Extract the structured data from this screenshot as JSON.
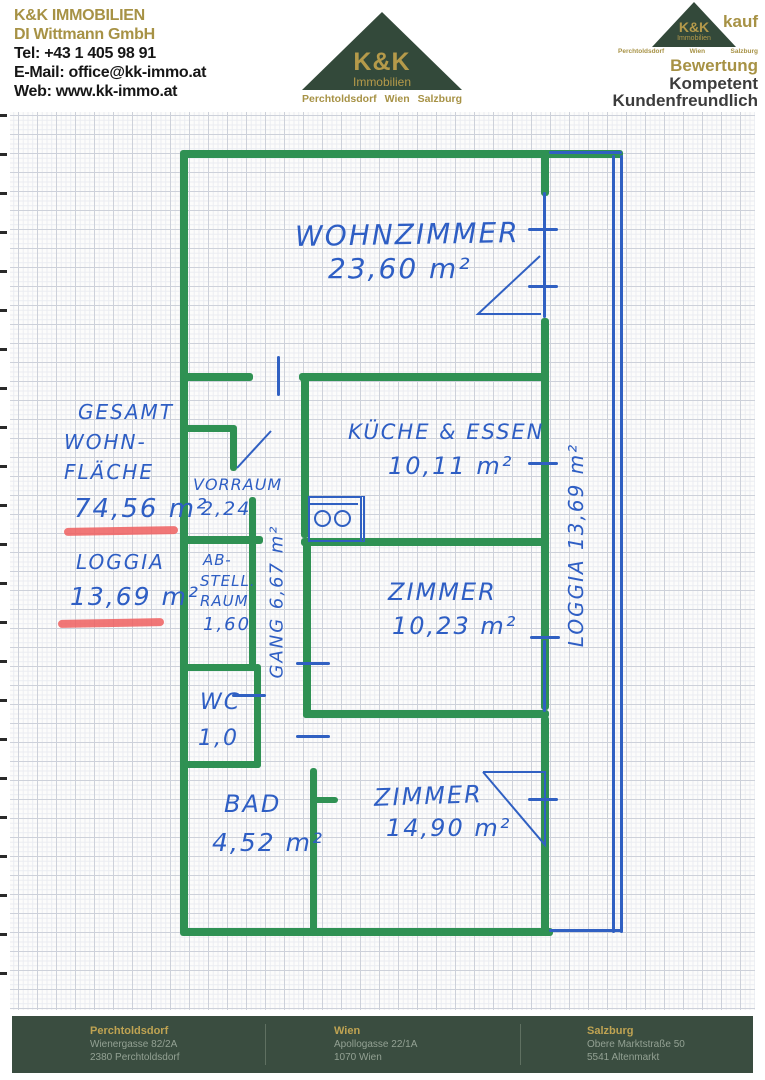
{
  "header": {
    "company": {
      "name": "K&K IMMOBILIEN",
      "subtitle": "DI Wittmann GmbH",
      "tel": "Tel: +43 1 405 98 91",
      "email": "E-Mail: office@kk-immo.at",
      "web": "Web: www.kk-immo.at"
    },
    "logo": {
      "brand": "K&K",
      "brand_sub": "Immobilien",
      "locations": [
        "Perchtoldsdorf",
        "Wien",
        "Salzburg"
      ]
    },
    "badge": {
      "brand": "K&K",
      "brand_sub": "Immobilien",
      "partial_word": "kauf",
      "tagline1": "Bewertung",
      "tagline2": "Kompetent",
      "tagline3": "Kundenfreundlich"
    }
  },
  "floorplan": {
    "summary": {
      "label_line1": "GESAMT",
      "label_line2": "WOHN-",
      "label_line3": "FLÄCHE",
      "total_area": "74,56 m²",
      "loggia_label": "LOGGIA",
      "loggia_area": "13,69 m²"
    },
    "rooms": {
      "wohnzimmer": {
        "name": "WOHNZIMMER",
        "area": "23,60 m²"
      },
      "kueche": {
        "name": "KÜCHE & ESSEN",
        "area": "10,11 m²"
      },
      "vorraum": {
        "name": "VORRAUM",
        "area": "2,24"
      },
      "abstellraum": {
        "name_line1": "AB-",
        "name_line2": "STELL.",
        "name_line3": "RAUM",
        "area": "1,60"
      },
      "gang": {
        "label": "GANG   6,67 m²"
      },
      "zimmer1": {
        "name": "ZIMMER",
        "area": "10,23 m²"
      },
      "wc": {
        "name": "WC",
        "area": "1,0"
      },
      "bad": {
        "name": "BAD",
        "area": "4,52 m²"
      },
      "zimmer2": {
        "name": "ZIMMER",
        "area": "14,90 m²"
      },
      "loggia": {
        "label": "LOGGIA   13,69 m²"
      }
    }
  },
  "footer": {
    "offices": [
      {
        "city": "Perchtoldsdorf",
        "street": "Wienergasse 82/2A",
        "zip": "2380 Perchtoldsdorf"
      },
      {
        "city": "Wien",
        "street": "Apollogasse 22/1A",
        "zip": "1070 Wien"
      },
      {
        "city": "Salzburg",
        "street": "Obere Marktstraße 50",
        "zip": "5541 Altenmarkt"
      }
    ]
  },
  "colors": {
    "marker_green": "#2f9153",
    "pen_blue": "#2e5ec4",
    "underline_red": "#ee5f5f",
    "brand_gold": "#a79245",
    "brand_dark_green": "#33493a",
    "footer_bg": "#3a4d40"
  }
}
